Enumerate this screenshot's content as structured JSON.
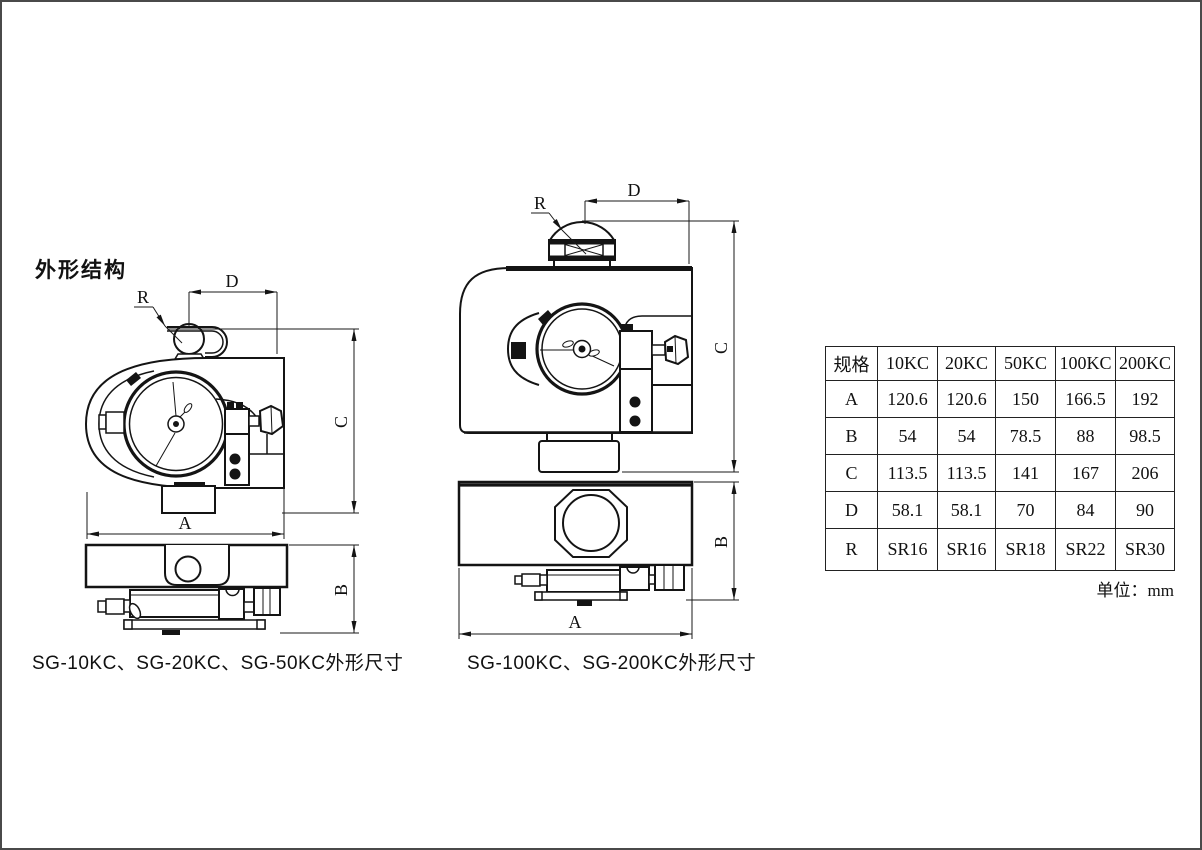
{
  "title": "外形结构",
  "drawings": {
    "left": {
      "caption": "SG-10KC、SG-20KC、SG-50KC外形尺寸",
      "dims": {
        "r": "R",
        "d": "D",
        "c": "C",
        "a": "A",
        "b": "B"
      }
    },
    "right": {
      "caption": "SG-100KC、SG-200KC外形尺寸",
      "dims": {
        "r": "R",
        "d": "D",
        "c": "C",
        "a": "A",
        "b": "B"
      }
    }
  },
  "table": {
    "headers": [
      "规格",
      "10KC",
      "20KC",
      "50KC",
      "100KC",
      "200KC"
    ],
    "rows": [
      [
        "A",
        "120.6",
        "120.6",
        "150",
        "166.5",
        "192"
      ],
      [
        "B",
        "54",
        "54",
        "78.5",
        "88",
        "98.5"
      ],
      [
        "C",
        "113.5",
        "113.5",
        "141",
        "167",
        "206"
      ],
      [
        "D",
        "58.1",
        "58.1",
        "70",
        "84",
        "90"
      ],
      [
        "R",
        "SR16",
        "SR16",
        "SR18",
        "SR22",
        "SR30"
      ]
    ],
    "unit_note": "单位：mm"
  }
}
